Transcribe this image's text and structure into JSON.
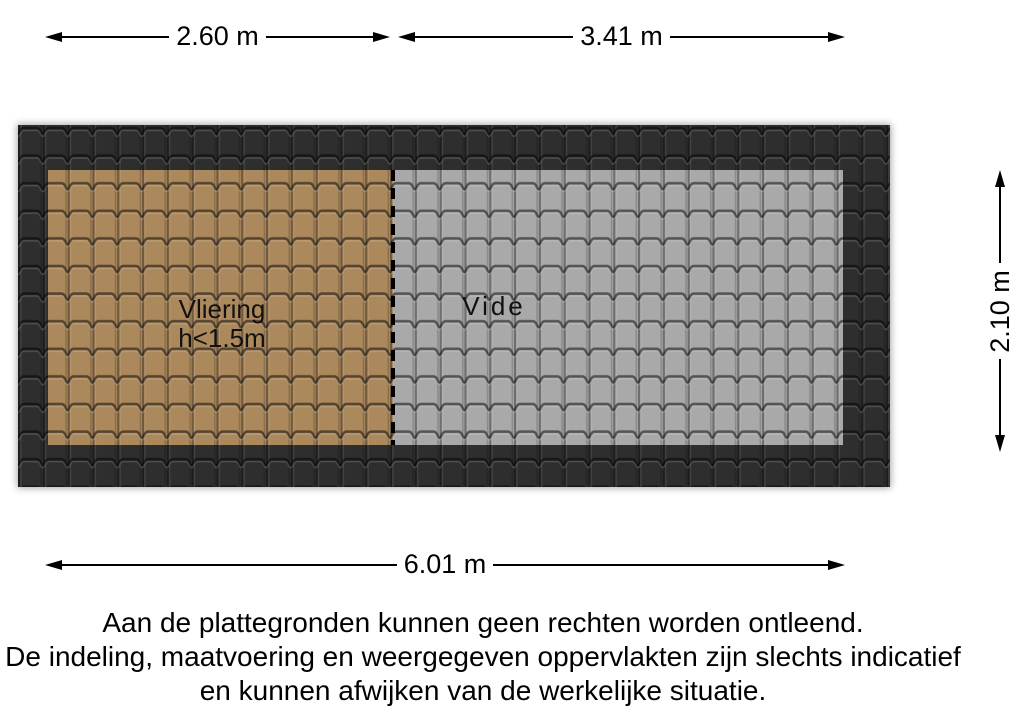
{
  "colors": {
    "background": "#ffffff",
    "roof_border_tile": "#2e2e2e",
    "vliering_tile": "#ac895c",
    "vide_tile": "#a9a9a9",
    "dimension_line": "#000000"
  },
  "floorplan": {
    "rooms": [
      {
        "name": "vliering",
        "label": "Vliering",
        "sublabel": "h<1.5m"
      },
      {
        "name": "vide",
        "label": "Vide"
      }
    ],
    "dimensions": {
      "top_left_width": "2.60 m",
      "top_right_width": "3.41 m",
      "height": "2.10 m",
      "total_width": "6.01 m"
    }
  },
  "disclaimer": {
    "line1": "Aan de plattegronden kunnen geen rechten worden ontleend.",
    "line2": "De indeling, maatvoering en weergegeven oppervlakten zijn slechts indicatief",
    "line3": "en kunnen afwijken van de werkelijke situatie."
  }
}
